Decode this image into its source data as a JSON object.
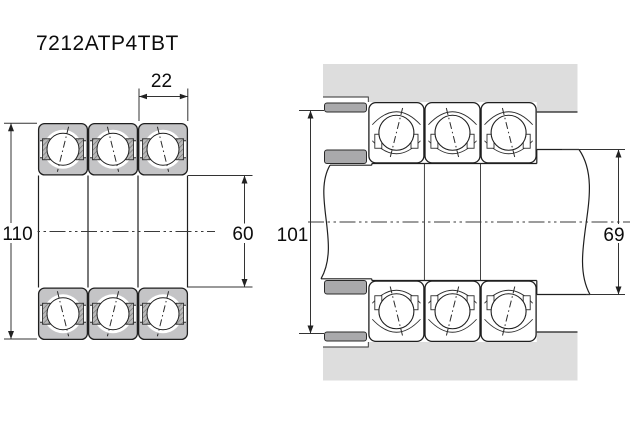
{
  "title": "7212ATP4TBT",
  "colors": {
    "background": "#ffffff",
    "line": "#1f1f1f",
    "bearing_ring_fill": "#c4c4c6",
    "housing_fill": "#dddddd",
    "spacer_fill": "#a9a9ab"
  },
  "left_view": {
    "bearing_count": 3,
    "outer_diameter": "110",
    "bore_diameter": "60",
    "bearing_width": "22"
  },
  "right_view": {
    "bearing_count": 3,
    "abutment_outer_diameter": "101",
    "abutment_shaft_diameter": "69"
  }
}
